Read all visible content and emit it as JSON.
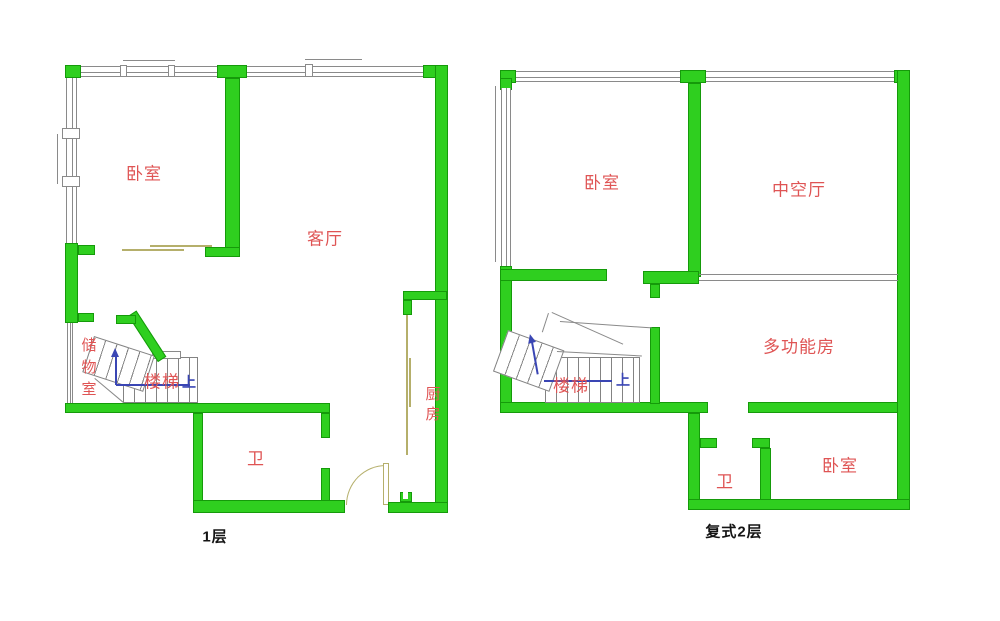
{
  "colors": {
    "wall": "#2fcf1f",
    "wallEdge": "#159a0a",
    "window": "#8a8a8a",
    "label": "#df5454",
    "door": "#b5af6b",
    "arrow": "#3a46b4",
    "caption": "#141414"
  },
  "floor1": {
    "caption": "1层",
    "labels": {
      "bedroom": "卧室",
      "living_room": "客厅",
      "kitchen": "厨房",
      "bathroom": "卫",
      "storage": "储物室",
      "stairs": "楼梯",
      "up": "上"
    }
  },
  "floor2": {
    "caption": "复式2层",
    "labels": {
      "bedroom_top": "卧室",
      "void_hall": "中空厅",
      "multi_room": "多功能房",
      "bedroom_bottom": "卧室",
      "bathroom": "卫",
      "stairs": "楼梯",
      "up": "上"
    }
  }
}
